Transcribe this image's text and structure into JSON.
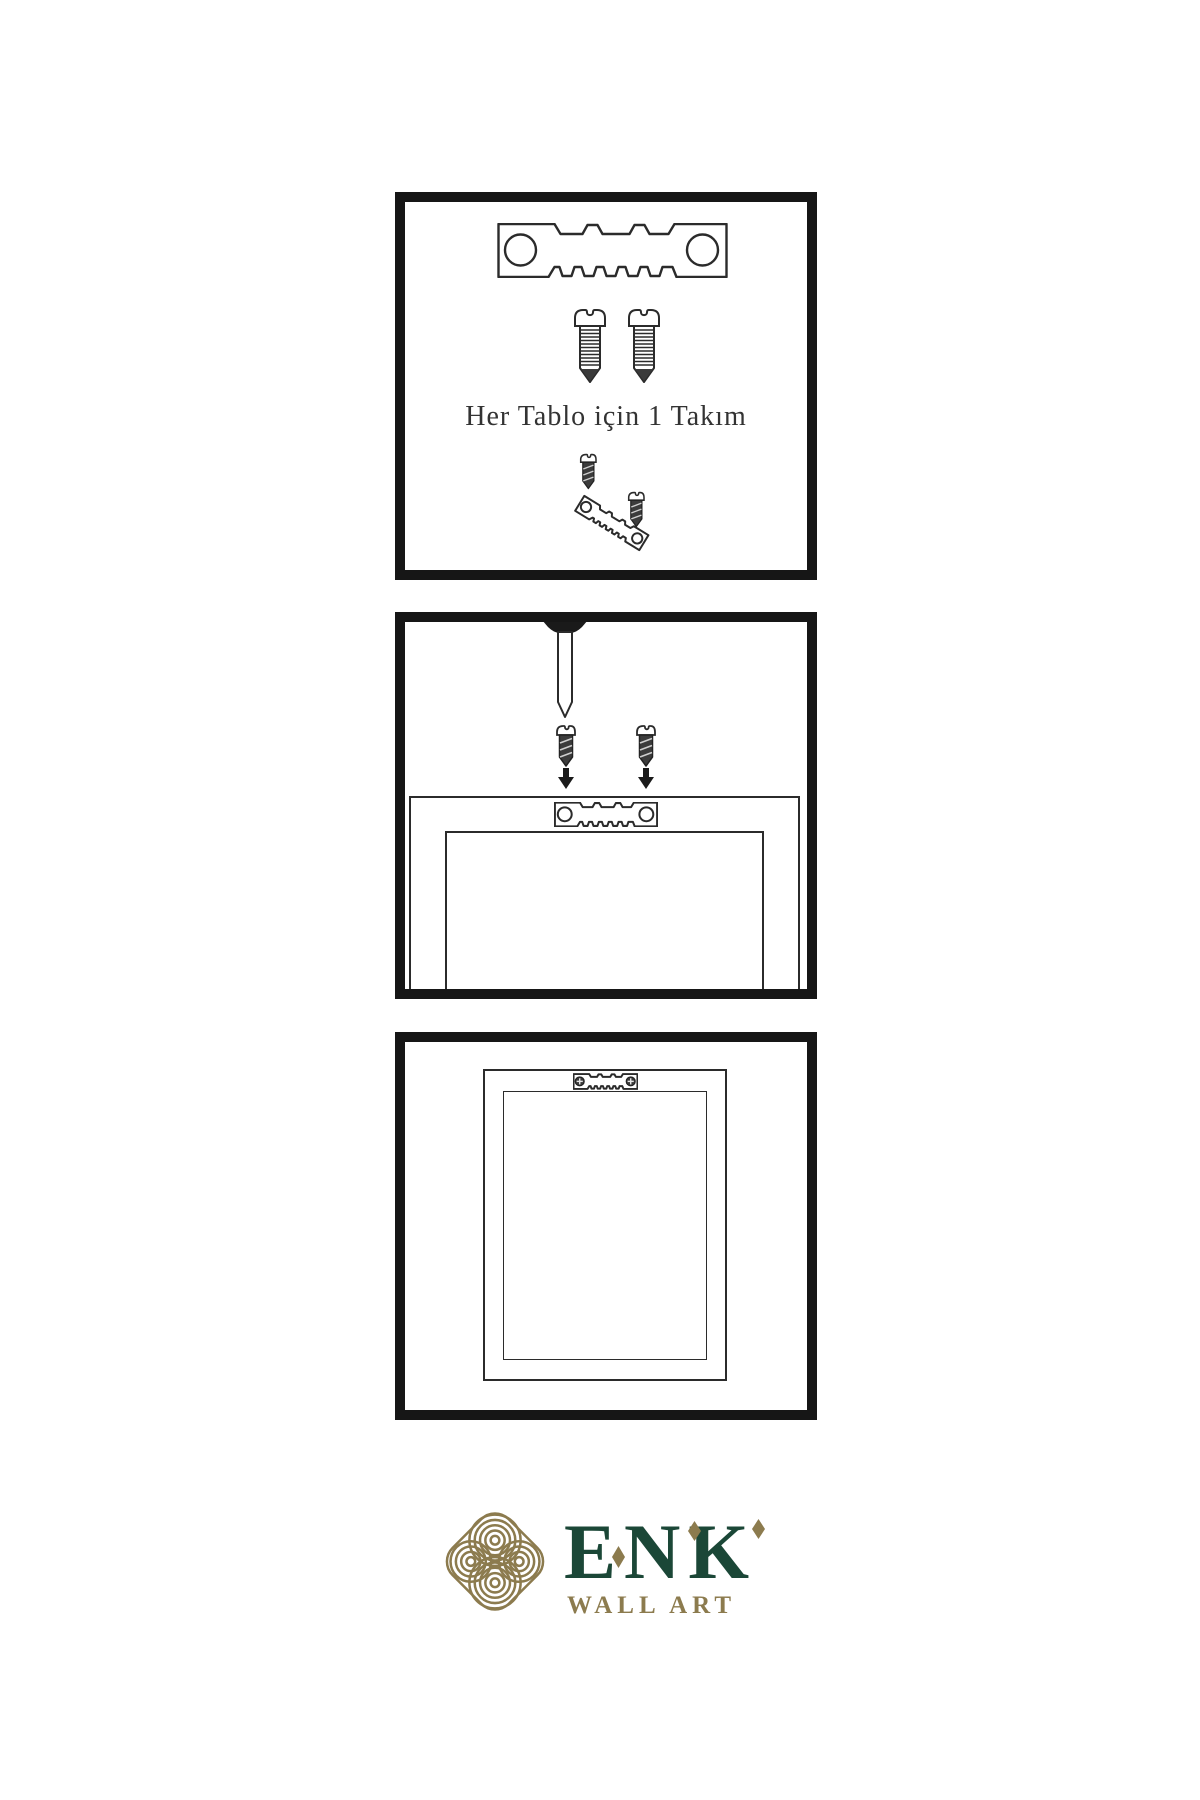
{
  "steps": {
    "step1": {
      "caption": "Her Tablo için 1 Takım",
      "icons": [
        "sawtooth-hanger-icon",
        "screw-icon",
        "screw-icon",
        "mini-diagram-screws-into-hanger"
      ]
    },
    "step2": {
      "icons": [
        "nail-icon",
        "dark-screw-icon",
        "dark-screw-icon",
        "arrow-down-icon",
        "arrow-down-icon",
        "sawtooth-hanger-icon",
        "frame-back-outline"
      ]
    },
    "step3": {
      "icons": [
        "installed-sawtooth-hanger-icon",
        "frame-back-outline"
      ]
    }
  },
  "brand": {
    "name": "ENK",
    "subtitle": "WALL ART",
    "logo": "interlaced-knot-icon"
  },
  "colors": {
    "background": "#ffffff",
    "panel_border": "#161616",
    "line_art": "#2b2b2b",
    "screw_dark": "#3c3c3c",
    "caption_text": "#333333",
    "brand_green": "#1b4737",
    "brand_gold": "#8c7b4e"
  }
}
